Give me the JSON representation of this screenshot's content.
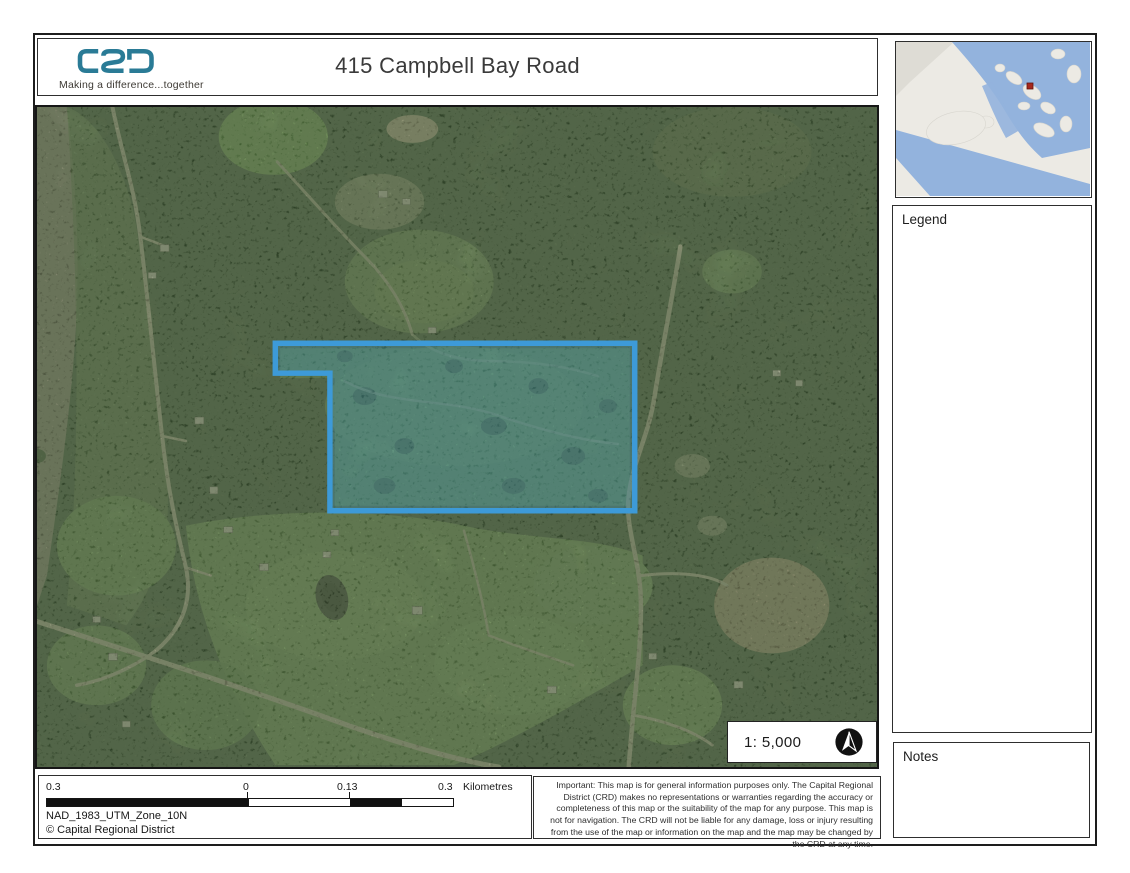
{
  "branding": {
    "logo_text": "CRD",
    "tagline": "Making a difference...together",
    "logo_color": "#2a7b96"
  },
  "header": {
    "title": "415 Campbell Bay Road"
  },
  "inset": {
    "water_color": "#93b3dd",
    "land_color": "#eceae4",
    "marker_color": "#a6281e"
  },
  "sidebar": {
    "legend_title": "Legend",
    "notes_title": "Notes"
  },
  "map": {
    "scale_text": "1: 5,000",
    "north_arrow_icon": "north-arrow-icon",
    "parcel_outline_color": "#3d9ad8",
    "parcel_fill_color": "rgba(62,158,200,0.30)"
  },
  "footer": {
    "scalebar": {
      "labels": [
        "0.3",
        "0",
        "0.13",
        "0.3"
      ],
      "unit": "Kilometres",
      "bar_colors": [
        "#111111",
        "#ffffff",
        "#111111",
        "#ffffff"
      ]
    },
    "projection": "NAD_1983_UTM_Zone_10N",
    "copyright": "© Capital Regional District",
    "disclaimer": "Important: This map is for general information purposes only. The Capital Regional District (CRD) makes no representations or warranties regarding the accuracy or completeness of this map or the suitability of the map for any purpose. This map is not for navigation. The CRD will not be liable for any damage, loss or injury resulting from the use of the map or information on the map and the map may be changed by the CRD at any time."
  }
}
